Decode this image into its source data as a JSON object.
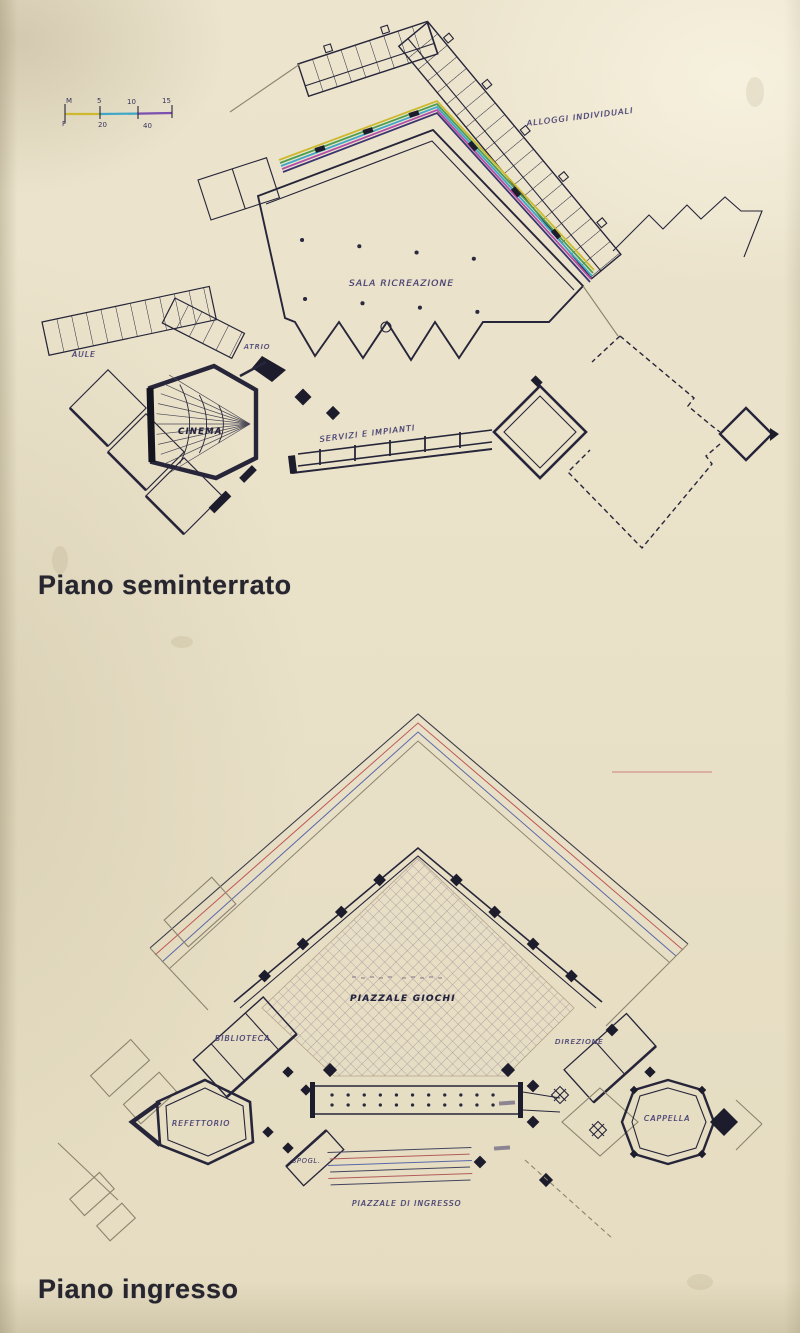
{
  "page": {
    "type": "scanned architectural plan page",
    "paper_color": "#e9e1c8",
    "ink_color": "#26253a"
  },
  "captions": {
    "upper": "Piano seminterrato",
    "lower": "Piano ingresso"
  },
  "scale_bar": {
    "top": [
      "M",
      "5",
      "10",
      "15"
    ],
    "bottom": [
      "F",
      "20",
      "40"
    ]
  },
  "upper_plan": {
    "labels": {
      "alloggi_individuali": "ALLOGGI INDIVIDUALI",
      "sala_ricreazione": "SALA RICREAZIONE",
      "aule": "AULE",
      "atrio": "ATRIO",
      "cinema": "CINEMA",
      "servizi_e_impianti": "SERVIZI E IMPIANTI"
    }
  },
  "lower_plan": {
    "labels": {
      "piazzale_giochi": "PIAZZALE GIOCHI",
      "biblioteca": "BIBLIOTECA",
      "refettorio": "REFETTORIO",
      "spogliatoio": "SPOGL.",
      "direzione": "DIREZIONE",
      "cappella": "CAPPELLA",
      "piazzale_di_ingresso": "PIAZZALE DI INGRESSO"
    }
  },
  "colors": {
    "rainbow_band": [
      "#cdb92e",
      "#4e9e50",
      "#3fa6c8",
      "#b44fa8",
      "#3a3470"
    ],
    "red_line": "#c05858",
    "blue_line": "#5a68a8",
    "scale_yellow": "#cdb92e",
    "scale_cyan": "#3fa6c8",
    "scale_violet": "#7a4fb0"
  }
}
